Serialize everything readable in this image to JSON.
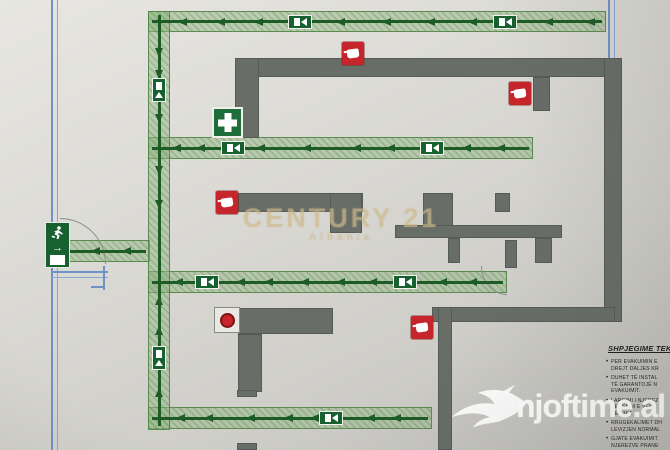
{
  "meta": {
    "description": "Photographed fire-evacuation floor plan (plan evakuimi)"
  },
  "colors": {
    "paper": "#d8d7d2",
    "route_fill": "rgba(148,184,132,0.5)",
    "route_line": "#1d5c26",
    "wall_gray": "#686d68",
    "exterior_blue": "#6e92c8",
    "extinguisher_red": "#c5252b",
    "sign_green": "#176030",
    "watermark_gold": "rgba(206,186,138,0.55)"
  },
  "icons": {
    "exit_sign": "running-man-exit-icon",
    "route_symbol": "exit-direction-icon",
    "extinguisher": "fire-extinguisher-icon",
    "first_aid": "first-aid-cross-icon",
    "alarm": "fire-alarm-button-icon",
    "bird": "njoftime-bird-logo"
  },
  "watermarks": {
    "century_line1": "CENTURY 21",
    "century_line2": "Albania",
    "njoftime": "njoftime.al"
  },
  "legend": {
    "heading": "SHPJEGIME TEKN",
    "bullets": [
      "PER EVAKUIMIN E\nDREJT DALJES KR",
      "DUHET TË INSTAL\nTË GARANTOJË N\nEVAKUIMIT.",
      "LARGIMI I NJEREZ\nVERSHIM E VEHE\nNE NIKA",
      "RRUGEKALIMET DH\nLEVIZJEN NORMAL",
      "GJATE EVAKUIMIT\nNJEREZVE PRANE"
    ]
  },
  "plan": {
    "routes": [
      {
        "name": "route-top",
        "x": 148,
        "y": 11,
        "w": 458,
        "h": 21,
        "dir": "h",
        "arrows": [
          182,
          220,
          258,
          340,
          386,
          430,
          472,
          548,
          590
        ],
        "symbols": [
          300,
          505
        ]
      },
      {
        "name": "route-second",
        "x": 148,
        "y": 137,
        "w": 385,
        "h": 22,
        "dir": "h",
        "arrows": [
          176,
          200,
          260,
          306,
          356,
          390,
          466,
          500
        ],
        "symbols": [
          233,
          432
        ]
      },
      {
        "name": "route-third",
        "x": 148,
        "y": 271,
        "w": 359,
        "h": 22,
        "dir": "h",
        "arrows": [
          178,
          240,
          268,
          304,
          340,
          372,
          442,
          472
        ],
        "symbols": [
          207,
          405
        ]
      },
      {
        "name": "route-bottom",
        "x": 148,
        "y": 407,
        "w": 284,
        "h": 22,
        "dir": "h",
        "arrows": [
          180,
          208,
          250,
          288,
          314,
          370,
          396
        ],
        "symbols": [
          331
        ]
      },
      {
        "name": "route-exit",
        "x": 66,
        "y": 240,
        "w": 84,
        "h": 22,
        "dir": "h",
        "arrows": [
          95,
          126
        ],
        "symbols": []
      },
      {
        "name": "route-trunk",
        "x": 148,
        "y": 11,
        "w": 22,
        "h": 419,
        "dir": "v",
        "arrows_down": [
          52,
          74,
          118,
          170,
          204
        ],
        "arrows_up": [
          300,
          330,
          392
        ],
        "symbols": [
          90,
          358
        ]
      }
    ],
    "walls": [
      [
        235,
        58,
        370,
        19
      ],
      [
        604,
        58,
        18,
        264
      ],
      [
        235,
        58,
        24,
        80
      ],
      [
        533,
        77,
        17,
        34
      ],
      [
        238,
        193,
        125,
        19
      ],
      [
        330,
        193,
        32,
        40
      ],
      [
        423,
        193,
        30,
        40
      ],
      [
        495,
        193,
        15,
        19
      ],
      [
        395,
        225,
        167,
        13
      ],
      [
        535,
        238,
        17,
        25
      ],
      [
        448,
        238,
        12,
        25
      ],
      [
        505,
        240,
        12,
        28
      ],
      [
        432,
        307,
        183,
        15
      ],
      [
        438,
        307,
        14,
        143
      ],
      [
        238,
        308,
        95,
        26
      ],
      [
        238,
        334,
        24,
        58
      ],
      [
        237,
        390,
        20,
        7
      ],
      [
        237,
        443,
        20,
        7
      ]
    ],
    "blue_lines": {
      "left_wall": {
        "x": 51,
        "y": 0,
        "h": 450
      },
      "top_right": {
        "x": 608,
        "y": 0,
        "h": 66
      },
      "door_lines": {
        "x": 52,
        "y": 271,
        "w": 56
      }
    },
    "extinguishers": [
      {
        "x": 342,
        "y": 42
      },
      {
        "x": 509,
        "y": 82
      },
      {
        "x": 216,
        "y": 191
      },
      {
        "x": 411,
        "y": 316
      }
    ],
    "first_aid": {
      "x": 212,
      "y": 107
    },
    "alarm": {
      "x": 214,
      "y": 307
    },
    "exit_sign": {
      "x": 45,
      "y": 222
    },
    "door_arcs": [
      {
        "type": "tr",
        "x": 60,
        "y": 218,
        "w": 46,
        "h": 46
      },
      {
        "type": "bl",
        "x": 481,
        "y": 266,
        "w": 26,
        "h": 29
      }
    ]
  }
}
